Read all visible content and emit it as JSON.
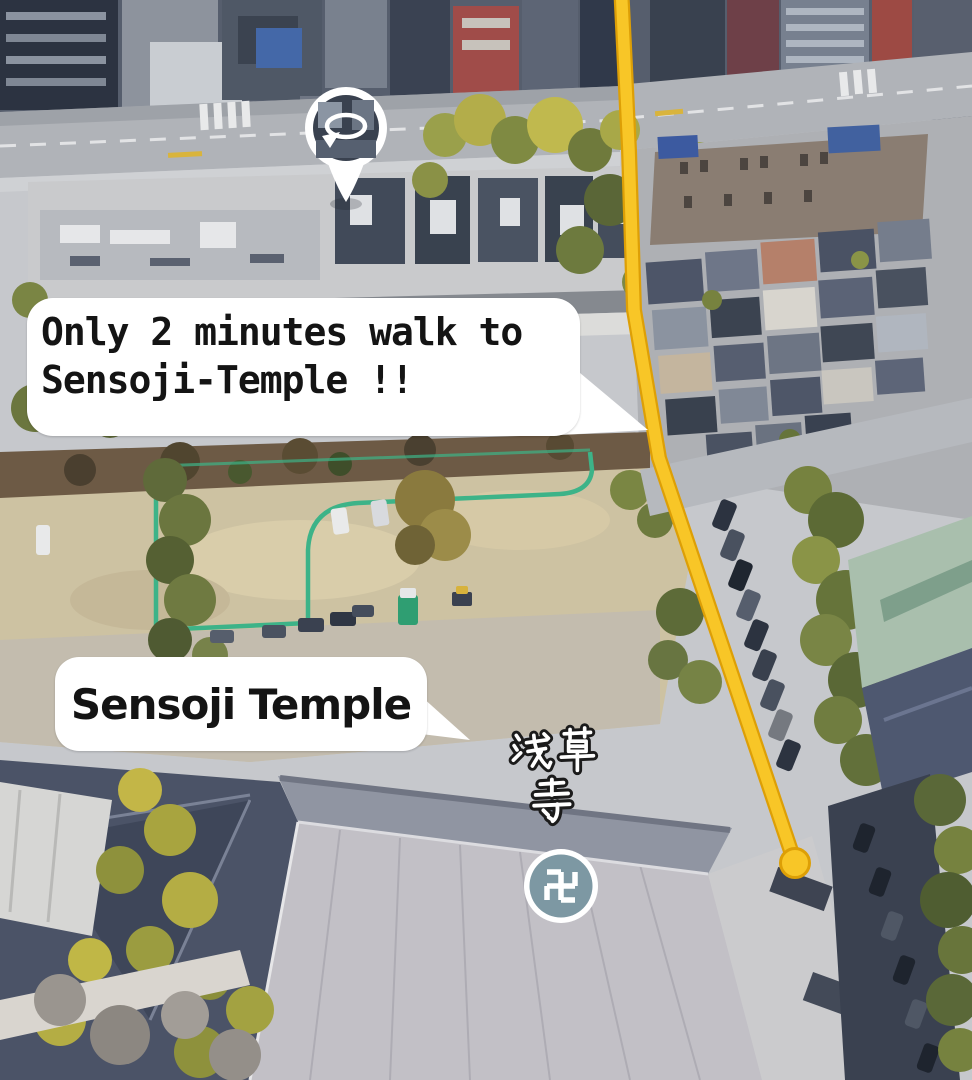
{
  "page": {
    "width": 972,
    "height": 1080,
    "kind": "annotated aerial 3D map"
  },
  "annotations": {
    "walk_bubble": {
      "line1": "Only 2 minutes walk to",
      "line2": "Sensoji-Temple !!"
    },
    "temple_bubble": {
      "label": "Sensoji Temple"
    },
    "temple_name_japanese": {
      "line1": "浅草",
      "line2": "寺",
      "full": "浅草寺"
    },
    "temple_marker": {
      "symbol": "卍"
    }
  },
  "icons": {
    "photosphere_marker": "photosphere-rotate-icon",
    "temple_marker": "manji-icon"
  },
  "colors": {
    "route": "#F8C627",
    "route_edge": "#DD9F06",
    "bubble_background": "#FFFFFF",
    "bubble_text": "#141414",
    "fence_line": "#3DB388",
    "temple_marker_fill": "#7D98A3",
    "temple_marker_ring": "#FFFFFF",
    "kanji_fill": "#FFFFFF",
    "kanji_outline": "#1B1B1B"
  }
}
